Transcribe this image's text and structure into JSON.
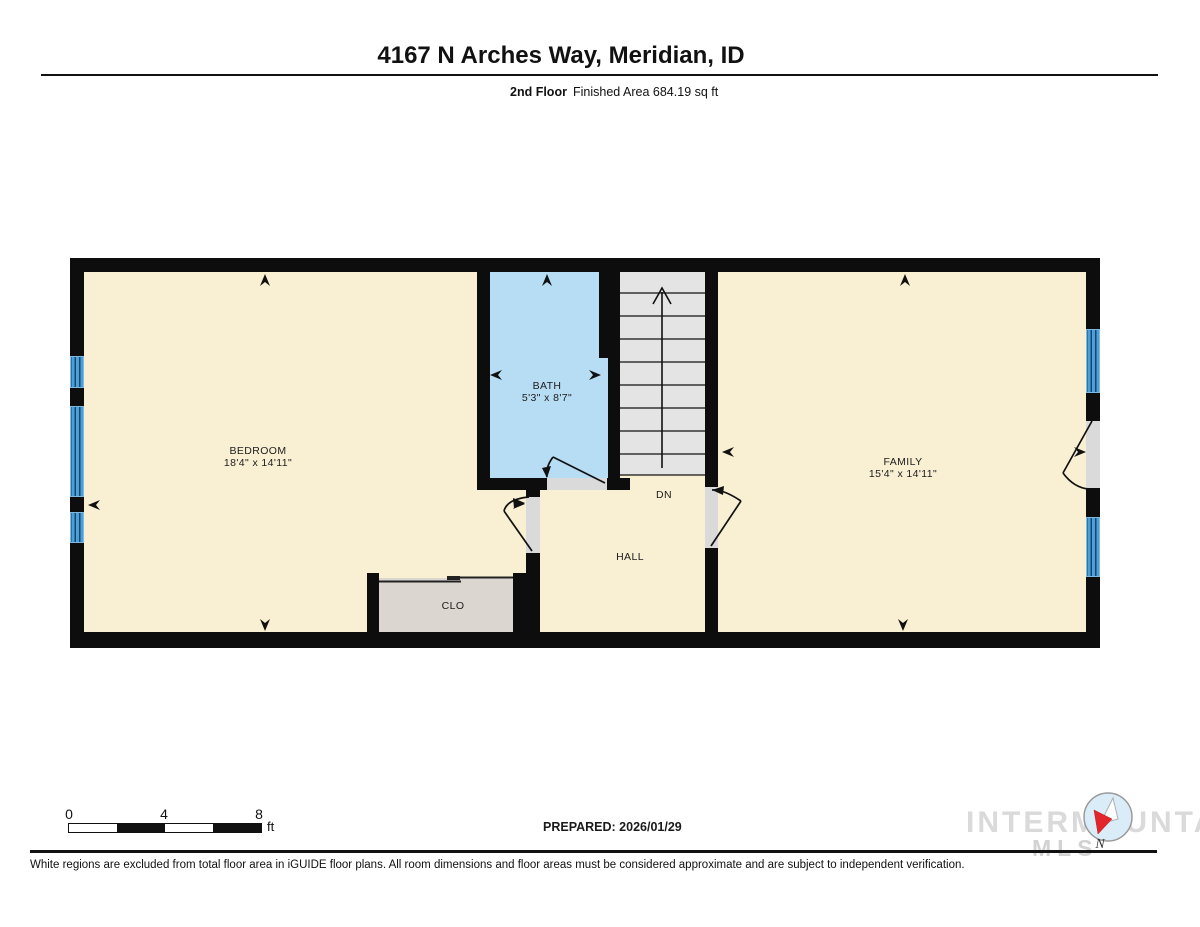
{
  "header": {
    "title": "4167 N Arches Way, Meridian, ID",
    "floor_label": "2nd Floor",
    "area_label": "Finished Area 684.19 sq ft"
  },
  "rooms": {
    "bedroom": {
      "name": "BEDROOM",
      "dims": "18'4\" x 14'11\""
    },
    "bath": {
      "name": "BATH",
      "dims": "5'3\" x 8'7\""
    },
    "family": {
      "name": "FAMILY",
      "dims": "15'4\" x 14'11\""
    },
    "hall": {
      "name": "HALL"
    },
    "closet": {
      "name": "CLO"
    },
    "stairs": {
      "dn_label": "DN"
    }
  },
  "scale": {
    "ticks": [
      "0",
      "4",
      "8"
    ],
    "unit": "ft"
  },
  "footer": {
    "prepared": "PREPARED: 2026/01/29",
    "disclaimer": "White regions are excluded from total floor area in iGUIDE floor plans. All room dimensions and floor areas must be considered approximate and are subject to independent verification.",
    "watermark": "INTERMOUNTAIN",
    "watermark_sub": "MLS",
    "compass_label": "N"
  },
  "colors": {
    "wall": "#0d0d0d",
    "room_fill": "#f9efd2",
    "bath_fill": "#b7ddf4",
    "stairs_fill": "#e4e4e4",
    "closet_fill": "#dbd7d0",
    "window_blue": "#4f9fd6",
    "needle_red": "#e3262c"
  }
}
